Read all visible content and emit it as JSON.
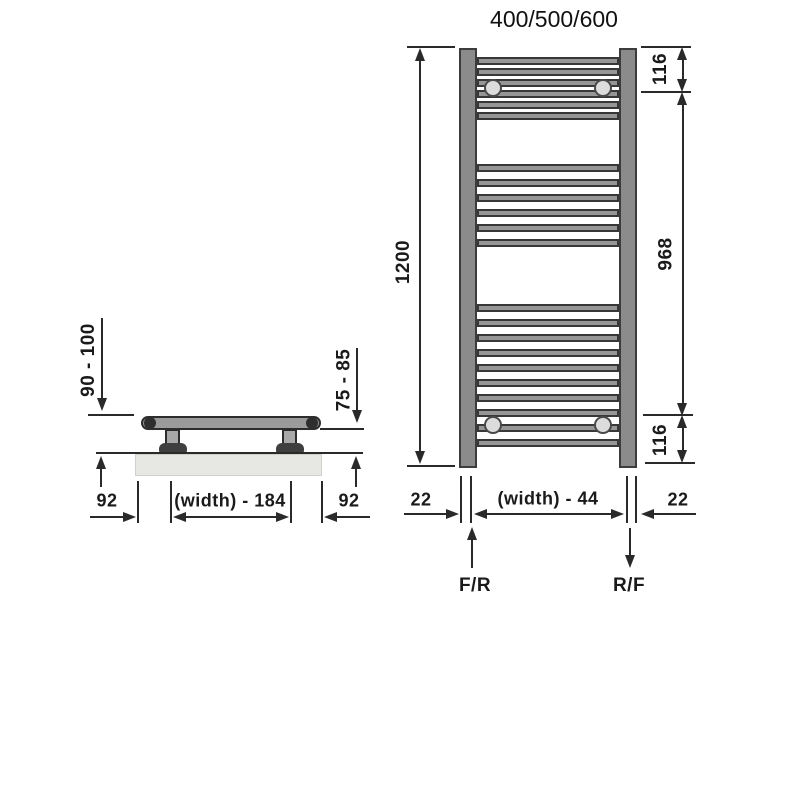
{
  "title": "400/500/600",
  "front_view": {
    "overall_height": "1200",
    "top_bracket_offset": "116",
    "bracket_span": "968",
    "bottom_bracket_offset": "116",
    "pipe_left_offset": "22",
    "pipe_centres": "(width) - 44",
    "pipe_right_offset": "22",
    "flow_in": "F/R",
    "flow_out": "R/F",
    "rung_ys": [
      61,
      72,
      83,
      94,
      105,
      116,
      168,
      183,
      198,
      213,
      228,
      243,
      308,
      323,
      338,
      353,
      368,
      383,
      398,
      413,
      428,
      443
    ],
    "bracket_circles": [
      [
        493,
        88
      ],
      [
        603,
        88
      ],
      [
        493,
        425
      ],
      [
        603,
        425
      ]
    ]
  },
  "side_view": {
    "wall_to_front": "90 - 100",
    "wall_to_rail": "75 - 85",
    "end_to_bracket_left": "92",
    "bracket_centres": "(width) - 184",
    "end_to_bracket_right": "92"
  },
  "colors": {
    "line": "#2a2a2a",
    "bar_fill": "#8b8b8b",
    "bracket_circle_fill": "#dcdcdc",
    "wall_fill": "#e7e7e3",
    "background": "#ffffff"
  }
}
